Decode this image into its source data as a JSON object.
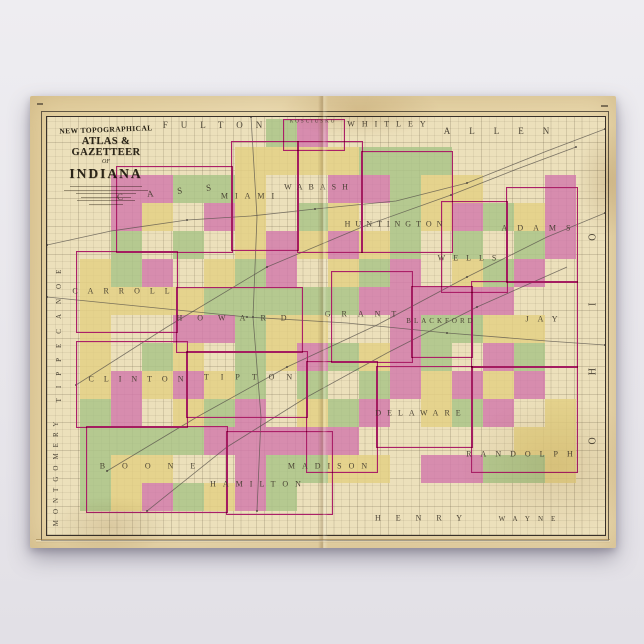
{
  "poster": {
    "background_color": "#e8e6eb"
  },
  "paper": {
    "color": "#e7d5a8"
  },
  "cartouche": {
    "line1": "NEW TOPOGRAPHICAL",
    "line2": "ATLAS & GAZETTEER",
    "line3": "OF",
    "line4": "INDIANA"
  },
  "map": {
    "background": "#ece0bb",
    "palette": {
      "pink": "#d279ab",
      "green": "#a8c386",
      "yellow": "#e3d083",
      "border_magenta": "#ab2068",
      "grid": "#8d8166",
      "frame": "#38312a",
      "rail": "#55504a"
    },
    "size": {
      "w": 558,
      "h": 418
    },
    "colored_zones": [
      {
        "x": 228,
        "y": 2,
        "w": 70,
        "h": 35
      },
      {
        "x": 184,
        "y": 24,
        "w": 220,
        "h": 120
      },
      {
        "x": 69,
        "y": 49,
        "w": 115,
        "h": 85
      },
      {
        "x": 394,
        "y": 56,
        "w": 135,
        "h": 118
      },
      {
        "x": 29,
        "y": 134,
        "w": 500,
        "h": 220
      },
      {
        "x": 39,
        "y": 304,
        "w": 250,
        "h": 90
      }
    ],
    "county_borders": [
      {
        "name": "kosciusko",
        "x": 236,
        "y": 2,
        "w": 60,
        "h": 30
      },
      {
        "name": "cass",
        "x": 69,
        "y": 49,
        "w": 115,
        "h": 85
      },
      {
        "name": "miami",
        "x": 184,
        "y": 24,
        "w": 66,
        "h": 108
      },
      {
        "name": "wabash",
        "x": 250,
        "y": 24,
        "w": 64,
        "h": 110
      },
      {
        "name": "huntington",
        "x": 314,
        "y": 34,
        "w": 90,
        "h": 100
      },
      {
        "name": "adams",
        "x": 459,
        "y": 70,
        "w": 70,
        "h": 94
      },
      {
        "name": "wells",
        "x": 394,
        "y": 84,
        "w": 65,
        "h": 90
      },
      {
        "name": "carroll",
        "x": 29,
        "y": 134,
        "w": 100,
        "h": 80
      },
      {
        "name": "howard",
        "x": 129,
        "y": 170,
        "w": 125,
        "h": 64
      },
      {
        "name": "grant",
        "x": 284,
        "y": 154,
        "w": 80,
        "h": 90
      },
      {
        "name": "blackford",
        "x": 364,
        "y": 169,
        "w": 60,
        "h": 70
      },
      {
        "name": "jay",
        "x": 424,
        "y": 164,
        "w": 105,
        "h": 85
      },
      {
        "name": "clinton",
        "x": 29,
        "y": 224,
        "w": 110,
        "h": 85
      },
      {
        "name": "tipton",
        "x": 139,
        "y": 234,
        "w": 120,
        "h": 65
      },
      {
        "name": "madison",
        "x": 259,
        "y": 244,
        "w": 70,
        "h": 110
      },
      {
        "name": "delaware",
        "x": 329,
        "y": 249,
        "w": 95,
        "h": 80
      },
      {
        "name": "randolph",
        "x": 424,
        "y": 249,
        "w": 105,
        "h": 105
      },
      {
        "name": "boone",
        "x": 39,
        "y": 309,
        "w": 140,
        "h": 85
      },
      {
        "name": "hamilton",
        "x": 179,
        "y": 314,
        "w": 105,
        "h": 82
      }
    ],
    "labels": [
      {
        "name": "fulton",
        "text": "FULTON",
        "x": 172,
        "y": 8,
        "size": 9,
        "spacing": 13,
        "rotate": 0
      },
      {
        "name": "kosciusko",
        "text": "KOSCIUSKO",
        "x": 266,
        "y": 5,
        "size": 5,
        "spacing": 2,
        "rotate": 0
      },
      {
        "name": "whitley",
        "text": "WHITLEY",
        "x": 343,
        "y": 7,
        "size": 8,
        "spacing": 7,
        "rotate": 0
      },
      {
        "name": "allen",
        "text": "ALLEN",
        "x": 459,
        "y": 14,
        "size": 9,
        "spacing": 19,
        "rotate": 0
      },
      {
        "name": "cass",
        "text": "CASS",
        "x": 129,
        "y": 74,
        "size": 9,
        "spacing": 24,
        "rotate": -6
      },
      {
        "name": "miami",
        "text": "MIAMI",
        "x": 204,
        "y": 79,
        "size": 8,
        "spacing": 7,
        "rotate": 0
      },
      {
        "name": "wabash",
        "text": "WABASH",
        "x": 272,
        "y": 70,
        "size": 8,
        "spacing": 6,
        "rotate": 0
      },
      {
        "name": "huntington",
        "text": "HUNTINGTON",
        "x": 349,
        "y": 107,
        "size": 8,
        "spacing": 5,
        "rotate": 0
      },
      {
        "name": "adams",
        "text": "ADAMS",
        "x": 494,
        "y": 111,
        "size": 8,
        "spacing": 10,
        "rotate": 0
      },
      {
        "name": "wells",
        "text": "WELLS",
        "x": 424,
        "y": 141,
        "size": 8,
        "spacing": 8,
        "rotate": 0
      },
      {
        "name": "carroll",
        "text": "CARROLL",
        "x": 79,
        "y": 174,
        "size": 8,
        "spacing": 10,
        "rotate": 0
      },
      {
        "name": "howard",
        "text": "HOWARD",
        "x": 192,
        "y": 201,
        "size": 8,
        "spacing": 15,
        "rotate": 0
      },
      {
        "name": "grant",
        "text": "GRANT",
        "x": 319,
        "y": 197,
        "size": 8,
        "spacing": 11,
        "rotate": 0
      },
      {
        "name": "blackford",
        "text": "BLACKFORD",
        "x": 394,
        "y": 204,
        "size": 7,
        "spacing": 3,
        "rotate": 0
      },
      {
        "name": "jay",
        "text": "JAY",
        "x": 499,
        "y": 202,
        "size": 8,
        "spacing": 9,
        "rotate": 0
      },
      {
        "name": "clinton",
        "text": "CLINTON",
        "x": 94,
        "y": 262,
        "size": 8,
        "spacing": 10,
        "rotate": 0
      },
      {
        "name": "tipton",
        "text": "TIPTON",
        "x": 207,
        "y": 260,
        "size": 8,
        "spacing": 12,
        "rotate": 0
      },
      {
        "name": "madison",
        "text": "MADISON",
        "x": 284,
        "y": 349,
        "size": 8,
        "spacing": 7,
        "rotate": 0
      },
      {
        "name": "delaware",
        "text": "DELAWARE",
        "x": 374,
        "y": 296,
        "size": 8,
        "spacing": 6,
        "rotate": 0
      },
      {
        "name": "randolph",
        "text": "RANDOLPH",
        "x": 477,
        "y": 337,
        "size": 8,
        "spacing": 9,
        "rotate": 0
      },
      {
        "name": "boone",
        "text": "BOONE",
        "x": 109,
        "y": 349,
        "size": 8,
        "spacing": 17,
        "rotate": 0
      },
      {
        "name": "hamilton",
        "text": "HAMILTON",
        "x": 212,
        "y": 367,
        "size": 8,
        "spacing": 7,
        "rotate": 0
      },
      {
        "name": "henry",
        "text": "HENRY",
        "x": 379,
        "y": 401,
        "size": 8,
        "spacing": 15,
        "rotate": 0
      },
      {
        "name": "wayne",
        "text": "WAYNE",
        "x": 484,
        "y": 402,
        "size": 7,
        "spacing": 8,
        "rotate": 0
      },
      {
        "name": "tippecanoe",
        "text": "TIPPECANOE",
        "x": 12,
        "y": 214,
        "size": 7,
        "spacing": 10,
        "rotate": -90
      },
      {
        "name": "montgomery",
        "text": "MONTGOMERY",
        "x": 9,
        "y": 354,
        "size": 7,
        "spacing": 6,
        "rotate": -90
      },
      {
        "name": "ohio",
        "text": "OHIO",
        "x": 546,
        "y": 191,
        "size": 10,
        "spacing": 62,
        "rotate": -90
      }
    ],
    "railroads": [
      [
        [
          0,
          128
        ],
        [
          64,
          114
        ],
        [
          140,
          103
        ],
        [
          204,
          99
        ],
        [
          268,
          92
        ],
        [
          349,
          84
        ],
        [
          420,
          66
        ],
        [
          500,
          34
        ],
        [
          558,
          12
        ]
      ],
      [
        [
          29,
          268
        ],
        [
          120,
          210
        ],
        [
          220,
          150
        ],
        [
          320,
          108
        ],
        [
          404,
          78
        ],
        [
          470,
          52
        ],
        [
          529,
          30
        ]
      ],
      [
        [
          60,
          354
        ],
        [
          150,
          300
        ],
        [
          240,
          250
        ],
        [
          330,
          208
        ],
        [
          420,
          160
        ],
        [
          500,
          120
        ],
        [
          558,
          96
        ]
      ],
      [
        [
          100,
          394
        ],
        [
          180,
          330
        ],
        [
          260,
          280
        ],
        [
          340,
          236
        ],
        [
          430,
          190
        ],
        [
          520,
          150
        ]
      ],
      [
        [
          204,
          0
        ],
        [
          210,
          100
        ],
        [
          206,
          200
        ],
        [
          214,
          300
        ],
        [
          210,
          394
        ]
      ],
      [
        [
          0,
          180
        ],
        [
          100,
          190
        ],
        [
          200,
          200
        ],
        [
          300,
          206
        ],
        [
          400,
          216
        ],
        [
          500,
          224
        ],
        [
          558,
          228
        ]
      ]
    ]
  }
}
